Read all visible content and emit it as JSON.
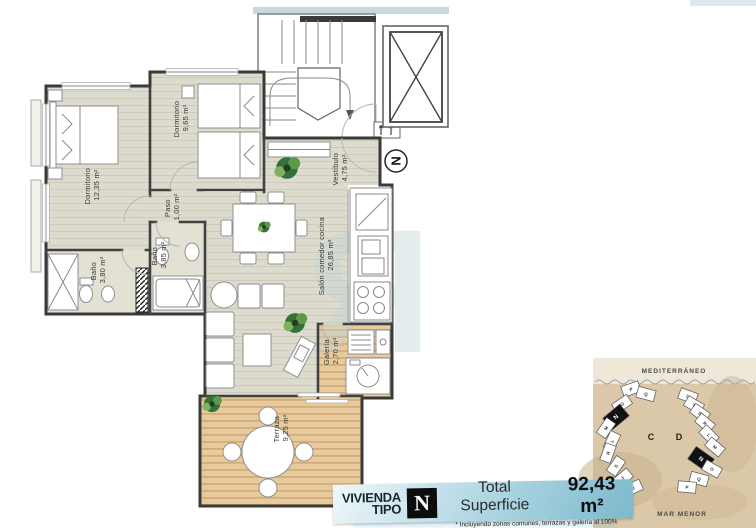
{
  "plan": {
    "north": "N",
    "rooms": [
      {
        "name": "Dormitorio",
        "area": "12,35 m²"
      },
      {
        "name": "Dormitorio",
        "area": "9,65 m²"
      },
      {
        "name": "Paso",
        "area": "1,00 m²"
      },
      {
        "name": "Baño",
        "area": "3,80 m²"
      },
      {
        "name": "Baño",
        "area": "3,85 m²"
      },
      {
        "name": "Salón comedor cocina",
        "area": "26,85 m²"
      },
      {
        "name": "Vestíbulo",
        "area": "4,75 m²"
      },
      {
        "name": "Galería",
        "area": "2,70 m²"
      },
      {
        "name": "Terraza",
        "area": "9,25 m²"
      }
    ]
  },
  "info_bar": {
    "label_line1": "VIVIENDA",
    "label_line2": "TIPO",
    "type_letter": "N",
    "superficie_label": "Total Superficie",
    "superficie_value": "92,43 m²",
    "footnote": "* Incluyendo zonas comunes, terrazas y galería al 100%"
  },
  "site_map": {
    "sea_label": "MEDITERRÁNEO",
    "bottom_label": "MAR MENOR",
    "cluster_c": {
      "label": "C",
      "highlight": "N",
      "units": [
        "P",
        "Q",
        "O",
        "N",
        "M",
        "L",
        "R",
        "S",
        "T",
        "U"
      ]
    },
    "cluster_d": {
      "label": "D",
      "highlight": "N",
      "units": [
        "U",
        "T",
        "S",
        "R",
        "L",
        "M",
        "N",
        "O",
        "Q",
        "P"
      ]
    }
  },
  "colors": {
    "floor": "#dcdbcd",
    "wood": "#e7cb9e",
    "bar_accent": "#8fc3d3",
    "wall": "#414141",
    "sand": "#dbc8a9",
    "highlight": "#111111"
  }
}
